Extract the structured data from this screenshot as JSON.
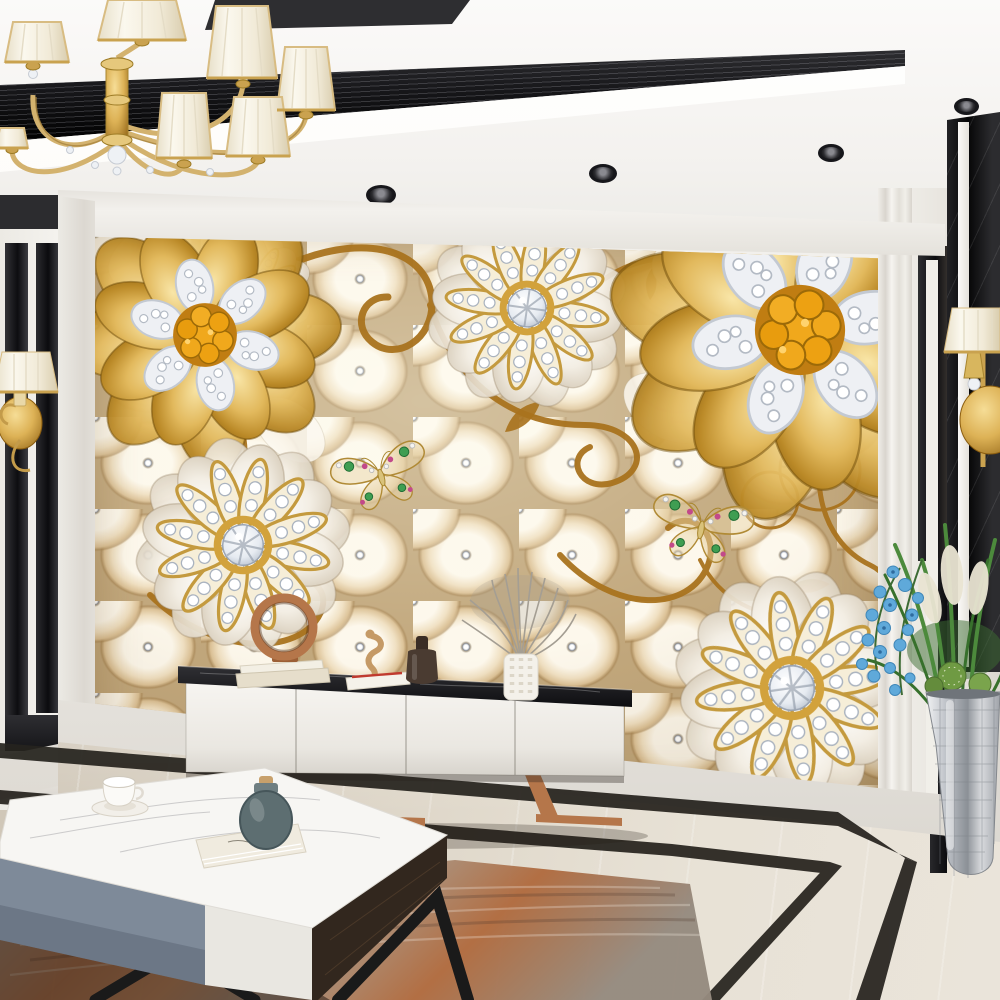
{
  "meta": {
    "description": "Photorealistic luxury living room: champagne tufted-upholstery 3D wall mural with gold and diamond jewelled flowers, crystal chandelier, white TV console with black marble top, marble coffee table, black marble inlay walls and floor, rug and plants",
    "room_type": "living room render",
    "no_visible_text": true
  },
  "palette": {
    "wallWhite": "#f2f0ec",
    "trayDark": "#17171a",
    "muralBase": "#c2a87d",
    "muralHighlight": "#fdf8ec",
    "gold": "#c89227",
    "goldDeep": "#8e6210",
    "vineGold": "#a9731e",
    "amber": "#f0a81c",
    "diamond": "#eef1f5",
    "marbleBlack": "#0c0c0f",
    "floorGreige": "#ddd5c7",
    "borderBlack": "#26231e",
    "copper": "#b5764a",
    "consoleWhite": "#f3f1ed",
    "tableGray": "#7e8a99",
    "tableWood": "#32271e",
    "tealVase": "#5d6e71",
    "orchidBlue": "#5fa9da",
    "plantGreen": "#4c8a3c",
    "silver": "#b9bdc3",
    "rugRust": "#b8744a"
  },
  "scene": {
    "ceiling": {
      "kind": "white tray ceiling with recessed black light channel",
      "spotlights": 5
    },
    "chandelier": {
      "kind": "gold chandelier with cream pleated shades and crystal balls",
      "visible_shades": 7
    },
    "mural": {
      "background": "champagne chesterfield tufting with crystal buttons",
      "flowers": [
        {
          "kind": "gold flower with amber gem cluster and diamond pave",
          "position": "upper-left"
        },
        {
          "kind": "small white jewel flower",
          "position": "top-left"
        },
        {
          "kind": "white flower with diamond rays and crystal center",
          "position": "top-center"
        },
        {
          "kind": "large gold flower with amber gem cluster",
          "position": "upper-right"
        },
        {
          "kind": "white flower with diamond rays",
          "position": "lower-left"
        },
        {
          "kind": "white flower with diamond rays",
          "position": "lower-right"
        }
      ],
      "butterflies": 2,
      "ornament": "golden scroll vines and leaves"
    },
    "left_wall": {
      "kind": "white wall with black marble stripe inlay and gold sconce"
    },
    "right_wall": {
      "kind": "white wall with black greek-key inlay, black marble column and gold sconce"
    },
    "tv_console": {
      "body": "white, 4 doors",
      "top": "black marble",
      "legs": "copper sled",
      "decor": [
        "copper ring sculpture on books",
        "seahorse figurine",
        "white books with red pen",
        "dark bottle vase",
        "white textured vase with dried grey plant"
      ]
    },
    "coffee_table": {
      "top": "white marble",
      "fronts": [
        "grey-blue drawer",
        "white drawer"
      ],
      "side": "dark walnut",
      "legs": "black metal",
      "decor": [
        "white tea cup on saucer",
        "grey-teal round vase",
        "white book"
      ]
    },
    "floor": {
      "kind": "beige marble with black marble inlay border"
    },
    "rug": {
      "kind": "distressed rust-and-grey area rug"
    },
    "plants": {
      "kind": "blue orchids, grasses, pampas, cactus balls in silver mosaic floor vase"
    }
  }
}
